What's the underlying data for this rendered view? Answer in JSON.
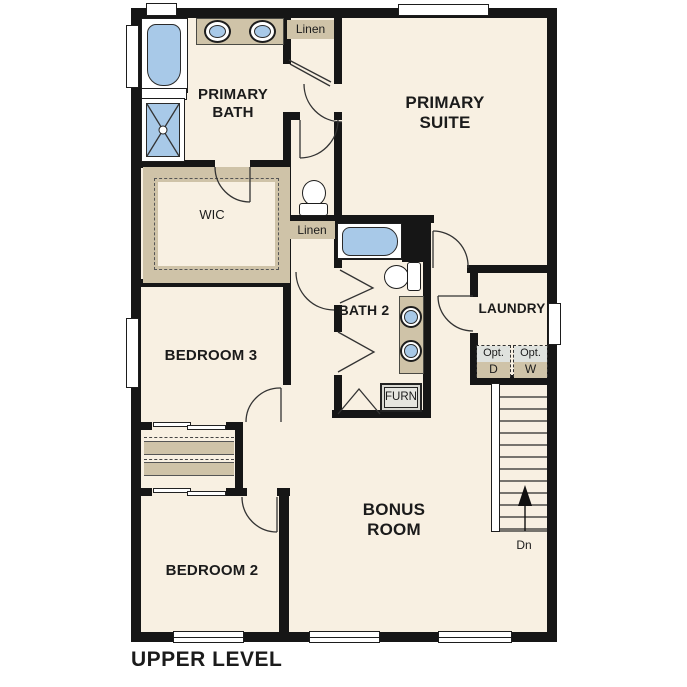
{
  "plan_title": "UPPER LEVEL",
  "rooms": {
    "primary_bath": "PRIMARY BATH",
    "primary_suite": "PRIMARY SUITE",
    "wic": "WIC",
    "bedroom_3": "BEDROOM 3",
    "bath_2": "BATH 2",
    "laundry": "LAUNDRY",
    "bonus_room": "BONUS ROOM",
    "bedroom_2": "BEDROOM 2"
  },
  "closets": {
    "linen_upper": "Linen",
    "linen_lower": "Linen"
  },
  "equipment": {
    "furnace": "FURN",
    "opt_dryer_line1": "Opt.",
    "opt_dryer_line2": "D",
    "opt_washer_line1": "Opt.",
    "opt_washer_line2": "W"
  },
  "stairs": {
    "down_label": "Dn"
  },
  "colors": {
    "wall": "#161616",
    "floor": "#f8f0e2",
    "fixture_blue": "#a8c9e8",
    "casework_tan": "#cfc3a8",
    "appliance_gray": "#dfe2de"
  }
}
